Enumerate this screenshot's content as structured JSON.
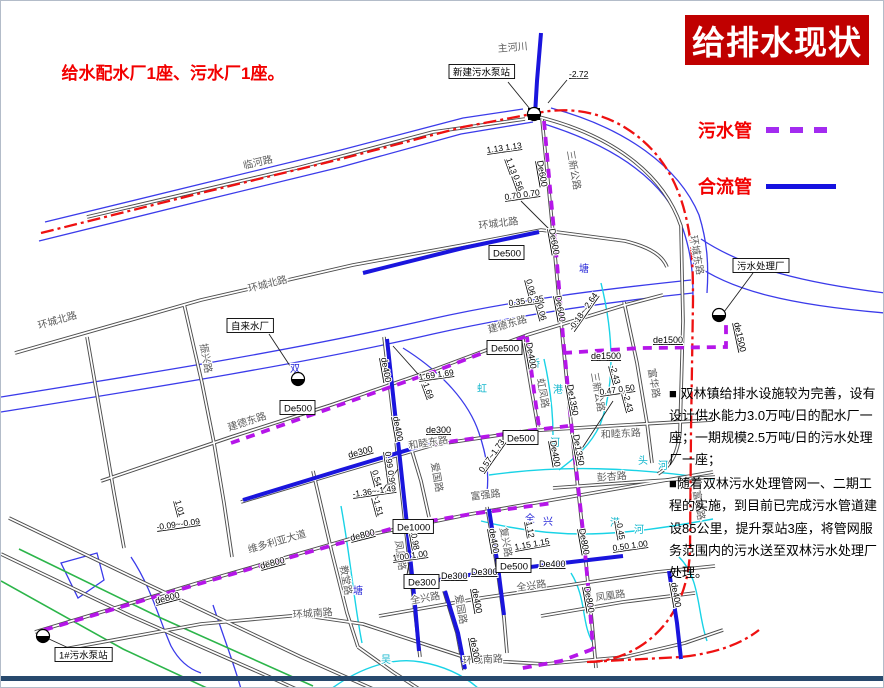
{
  "title": {
    "text": "给排水现状",
    "bg": "#c00000",
    "color": "#ffffff"
  },
  "legend": {
    "items": [
      {
        "label": "污水管",
        "style": "dashed",
        "color": "#a32bf0"
      },
      {
        "label": "合流管",
        "style": "solid",
        "color": "#1512e0"
      }
    ]
  },
  "note": {
    "text": "给水配水厂1座、污水厂1座。"
  },
  "description": {
    "p1": "■ 双林镇给排水设施较为完善，设有设计供水能力3.0万吨/日的配水厂一座；一期规模2.5万吨/日的污水处理厂一座；",
    "p2": "■随着双林污水处理管网一、二期工程的实施，到目前已完成污水管道建设85公里，提升泵站3座，将管网服务范围内的污水送至双林污水处理厂处理。"
  },
  "footer": {
    "bar_color": "#27496d"
  },
  "map": {
    "colors": {
      "road": "#4d4d4d",
      "river": "#3b3bea",
      "river_text": "#2929d8",
      "canal": "#19d3e6",
      "canal_text": "#10b6cc",
      "green": "#2cb54a",
      "boundary": "#ee1111",
      "sewage": "#b516e9",
      "combined": "#1a15dd"
    },
    "roads": [
      "M86,216 L300,166 L432,131 L524,118",
      "M538,116 C610,134 662,172 680,225 L682,320 L679,430 C677,455 668,466 657,473",
      "M14,352 L200,299 L352,264 L462,244 L540,229 L624,240 C652,247 662,256 666,266",
      "M100,480 L230,436 L330,404 L432,369 L526,334 L624,304 L662,294",
      "M240,501 L340,471 L432,444 L526,430 L624,424 L712,419",
      "M34,631 L200,581 L352,537 L470,513 L580,494 L712,471",
      "M378,615 L480,597 L562,585 L656,571 L714,565",
      "M58,649 L200,623 L300,614 L362,623 L432,646 L472,659 L544,663 L624,656 L684,642 L722,629",
      "M383,336 L395,440 L404,522 L413,602 L419,656",
      "M541,118 L552,232 L561,332 L573,452 L583,542 L591,622 L595,667",
      "M312,470 L331,552 L346,612 L357,646",
      "M486,506 L496,566 L503,617 L506,652",
      "M408,440 L420,480 L428,516",
      "M443,590 L456,632 L463,669",
      "M183,303 L201,382 L213,442 L223,502 L231,556",
      "M86,336 L101,422 L113,492 L123,547",
      "M623,301 L636,362 L646,422 L651,462",
      "M552,487 L650,480 L714,476",
      "M8,517 L150,585 L300,656 L372,688",
      "M0,553 L130,615 L262,673 L295,688",
      "M357,646 L392,671 L418,688",
      "M522,338 L531,392 L537,426",
      "M540,615 L622,601 L694,592"
    ],
    "rivers": [
      "M38,240 L200,200 L340,166 L460,133 L532,121",
      "M44,221 L200,183 L340,149 L462,117 L522,108",
      "M540,122 C615,145 664,180 682,228 C690,252 692,270 692,296",
      "M550,107 C625,127 678,166 698,214 C706,240 708,262 706,292",
      "M692,262 C730,290 790,304 884,312",
      "M700,238 C745,268 805,282 884,292",
      "M0,396 C150,372 300,348 430,318 C520,298 605,288 690,279",
      "M0,411 C150,387 302,363 432,333 C522,313 606,301 692,292",
      "M402,347 C442,372 468,402 478,432 C486,456 488,472 486,492",
      "M60,562 L96,552 L103,579 L77,597 Z",
      "M130,556 C150,586 158,618 170,645 C178,660 188,668 200,672",
      "M212,604 C224,640 234,666 240,688"
    ],
    "canals": [
      "M600,282 C613,335 614,385 599,424 C588,447 572,458 558,469",
      "M543,358 C549,385 552,410 552,434",
      "M488,474 C560,464 630,466 712,478",
      "M480,520 C560,540 620,535 712,518",
      "M340,505 C350,560 353,602 361,642",
      "M330,688 C360,666 392,656 420,661 C448,666 466,677 478,688",
      "M570,572 C586,598 580,622 592,642",
      "M678,556 C700,578 696,612 706,640"
    ],
    "greens": [
      "M18,548 L160,617 L312,685",
      "M0,580 L122,648 L208,688"
    ],
    "boundary": [
      "M40,232 L200,192 L340,158 L462,126 L536,112 C566,106 592,110 616,122 C652,141 674,172 684,212 C691,240 692,262 692,300 L690,430 L689,548 C688,592 670,626 638,646 C618,658 600,661 586,661",
      "M586,661 L680,656 C716,652 740,643 758,629"
    ],
    "combined_pipes": [
      "M362,272 L462,247 L538,231",
      "M540,32 L536,80 L534,114",
      "M386,338 L397,440 L406,524 L414,604 L418,650",
      "M242,499 L340,469 L430,442",
      "M408,584 L480,572 L562,562 L622,555",
      "M488,508 L497,566 L503,614",
      "M444,590 L457,632 L464,668",
      "M668,570 L676,622 L680,658"
    ],
    "sewage_pipes": [
      "M543,120 L550,198 L556,262 L562,335 L570,420 L576,475 L582,530 L588,595 L592,648",
      "M562,352 L640,347 L725,346 L725,318",
      "M230,442 L330,407 L432,371 L526,335",
      "M43,629 L150,597 L262,564 L400,525 L470,513 L552,502",
      "M432,443 L525,430 L567,425",
      "M526,336 L533,390 L538,426",
      "M592,648 L560,660 L516,668"
    ],
    "leaders": [
      [
        507,
        81,
        529,
        108
      ],
      [
        566,
        79,
        547,
        102
      ],
      [
        268,
        333,
        295,
        374
      ],
      [
        752,
        272,
        723,
        311
      ],
      [
        72,
        649,
        48,
        638
      ],
      [
        520,
        200,
        549,
        229
      ],
      [
        612,
        400,
        578,
        452
      ],
      [
        425,
        382,
        392,
        345
      ],
      [
        375,
        498,
        397,
        468
      ],
      [
        408,
        562,
        405,
        580
      ]
    ],
    "road_labels": [
      {
        "t": "临河路",
        "x": 243,
        "y": 168,
        "r": -13
      },
      {
        "t": "环城北路",
        "x": 38,
        "y": 328,
        "r": -16
      },
      {
        "t": "环城北路",
        "x": 248,
        "y": 291,
        "r": -14
      },
      {
        "t": "环城北路",
        "x": 478,
        "y": 228,
        "r": -7
      },
      {
        "t": "环城东路",
        "x": 689,
        "y": 235,
        "r": 80
      },
      {
        "t": "建德东路",
        "x": 228,
        "y": 430,
        "r": -18
      },
      {
        "t": "建德东路",
        "x": 488,
        "y": 332,
        "r": -16
      },
      {
        "t": "和睦东路",
        "x": 408,
        "y": 448,
        "r": -9
      },
      {
        "t": "和睦东路",
        "x": 600,
        "y": 437,
        "r": -3
      },
      {
        "t": "维多利亚大道",
        "x": 248,
        "y": 552,
        "r": -16
      },
      {
        "t": "富强路",
        "x": 470,
        "y": 499,
        "r": -7
      },
      {
        "t": "全兴路",
        "x": 410,
        "y": 603,
        "r": -10
      },
      {
        "t": "全兴路",
        "x": 516,
        "y": 590,
        "r": -8
      },
      {
        "t": "环城南路",
        "x": 292,
        "y": 617,
        "r": -4
      },
      {
        "t": "环城南路",
        "x": 462,
        "y": 663,
        "r": -3
      },
      {
        "t": "凤凰路",
        "x": 394,
        "y": 540,
        "r": 82
      },
      {
        "t": "凤凰路",
        "x": 595,
        "y": 600,
        "r": -8
      },
      {
        "t": "教堂路",
        "x": 339,
        "y": 565,
        "r": 80
      },
      {
        "t": "爱国路",
        "x": 430,
        "y": 462,
        "r": 80
      },
      {
        "t": "爱园路",
        "x": 454,
        "y": 594,
        "r": 80
      },
      {
        "t": "复兴路",
        "x": 499,
        "y": 527,
        "r": 80
      },
      {
        "t": "振兴路",
        "x": 199,
        "y": 343,
        "r": 80
      },
      {
        "t": "三新公路",
        "x": 566,
        "y": 150,
        "r": 80
      },
      {
        "t": "三新公路",
        "x": 590,
        "y": 372,
        "r": 80
      },
      {
        "t": "富华路",
        "x": 647,
        "y": 368,
        "r": 80
      },
      {
        "t": "彭杏路",
        "x": 596,
        "y": 480,
        "r": -4
      },
      {
        "t": "虹凤路",
        "x": 536,
        "y": 378,
        "r": 80
      },
      {
        "t": "富安路",
        "x": 692,
        "y": 490,
        "r": 80
      },
      {
        "t": "主河川",
        "x": 497,
        "y": 51,
        "r": -5,
        "s": 8
      }
    ],
    "river_labels": [
      {
        "t": "塘",
        "x": 578,
        "y": 271,
        "c": "b"
      },
      {
        "t": "双",
        "x": 289,
        "y": 371,
        "c": "b"
      },
      {
        "t": "塘",
        "x": 352,
        "y": 593,
        "c": "b"
      },
      {
        "t": "吴",
        "x": 380,
        "y": 662,
        "c": "c"
      },
      {
        "t": "虹",
        "x": 476,
        "y": 391,
        "c": "c"
      },
      {
        "t": "桥",
        "x": 529,
        "y": 366,
        "c": "c"
      },
      {
        "t": "港",
        "x": 552,
        "y": 392,
        "c": "c"
      },
      {
        "t": "头",
        "x": 637,
        "y": 463,
        "c": "c"
      },
      {
        "t": "河",
        "x": 657,
        "y": 468,
        "c": "c"
      },
      {
        "t": "港",
        "x": 609,
        "y": 525,
        "c": "c"
      },
      {
        "t": "河",
        "x": 633,
        "y": 532,
        "c": "c"
      },
      {
        "t": "全",
        "x": 524,
        "y": 521,
        "c": "b"
      },
      {
        "t": "兴",
        "x": 542,
        "y": 524,
        "c": "b"
      },
      {
        "t": "河",
        "x": 549,
        "y": 445,
        "c": "c"
      }
    ],
    "pipe_labels": [
      {
        "t": "De600",
        "x": 536,
        "y": 160,
        "r": 80
      },
      {
        "t": "De600",
        "x": 548,
        "y": 228,
        "r": 80
      },
      {
        "t": "De600",
        "x": 554,
        "y": 295,
        "r": 80
      },
      {
        "t": "De1350",
        "x": 566,
        "y": 384,
        "r": 80
      },
      {
        "t": "De1350",
        "x": 572,
        "y": 434,
        "r": 80
      },
      {
        "t": "De800",
        "x": 578,
        "y": 528,
        "r": 80
      },
      {
        "t": "De800",
        "x": 583,
        "y": 586,
        "r": 80
      },
      {
        "t": "de1500",
        "x": 590,
        "y": 358,
        "r": 0
      },
      {
        "t": "de1500",
        "x": 652,
        "y": 342,
        "r": 0
      },
      {
        "t": "de1500",
        "x": 733,
        "y": 322,
        "r": 78
      },
      {
        "t": "De500",
        "x": 283,
        "y": 410,
        "b": 1
      },
      {
        "t": "De500",
        "x": 490,
        "y": 350,
        "b": 1
      },
      {
        "t": "de800",
        "x": 155,
        "y": 603,
        "r": -15
      },
      {
        "t": "de800",
        "x": 260,
        "y": 568,
        "r": -15
      },
      {
        "t": "de800",
        "x": 350,
        "y": 540,
        "r": -14
      },
      {
        "t": "De1000",
        "x": 396,
        "y": 529,
        "b": 1
      },
      {
        "t": "De500",
        "x": 506,
        "y": 440,
        "b": 1
      },
      {
        "t": "De400",
        "x": 549,
        "y": 440,
        "r": 80
      },
      {
        "t": "De400",
        "x": 525,
        "y": 342,
        "r": 80
      },
      {
        "t": "De500",
        "x": 492,
        "y": 255,
        "b": 1
      },
      {
        "t": "De300",
        "x": 407,
        "y": 584,
        "b": 1
      },
      {
        "t": "de300",
        "x": 348,
        "y": 457,
        "r": -15
      },
      {
        "t": "de300",
        "x": 425,
        "y": 432,
        "r": 0
      },
      {
        "t": "De300",
        "x": 440,
        "y": 578,
        "r": 0
      },
      {
        "t": "De300",
        "x": 470,
        "y": 574,
        "r": 0
      },
      {
        "t": "De500",
        "x": 499,
        "y": 568,
        "b": 1
      },
      {
        "t": "De400",
        "x": 538,
        "y": 566,
        "r": 0
      },
      {
        "t": "de400",
        "x": 488,
        "y": 528,
        "r": 80
      },
      {
        "t": "de400",
        "x": 471,
        "y": 588,
        "r": 80
      },
      {
        "t": "de300",
        "x": 469,
        "y": 637,
        "r": 80
      },
      {
        "t": "de400",
        "x": 670,
        "y": 582,
        "r": 80
      },
      {
        "t": "de400",
        "x": 380,
        "y": 357,
        "r": 80
      },
      {
        "t": "de400",
        "x": 392,
        "y": 416,
        "r": 80
      }
    ],
    "values": [
      {
        "t": "-2.72",
        "x": 568,
        "y": 76,
        "r": 0
      },
      {
        "t": "1.13 1.13",
        "x": 486,
        "y": 152,
        "r": -8
      },
      {
        "t": "1.13",
        "x": 505,
        "y": 158,
        "r": 70
      },
      {
        "t": "0.56",
        "x": 512,
        "y": 175,
        "r": 70
      },
      {
        "t": "0.70 0.70",
        "x": 504,
        "y": 199,
        "r": -8
      },
      {
        "t": "0.06",
        "x": 525,
        "y": 279,
        "r": 75
      },
      {
        "t": "0.35 0.35",
        "x": 508,
        "y": 305,
        "r": -8
      },
      {
        "t": "0.06",
        "x": 536,
        "y": 304,
        "r": 75
      },
      {
        "t": "-0.18~-2.64",
        "x": 572,
        "y": 330,
        "r": -55
      },
      {
        "t": "1.69 1.69",
        "x": 418,
        "y": 379,
        "r": -8
      },
      {
        "t": "1.69",
        "x": 422,
        "y": 383,
        "r": 70
      },
      {
        "t": "-2.43",
        "x": 609,
        "y": 365,
        "r": 75
      },
      {
        "t": "0.47 0.50",
        "x": 599,
        "y": 394,
        "r": -8
      },
      {
        "t": "-2.43",
        "x": 622,
        "y": 393,
        "r": 75
      },
      {
        "t": "0.99 0.99",
        "x": 384,
        "y": 451,
        "r": 82
      },
      {
        "t": "0.54",
        "x": 371,
        "y": 470,
        "r": 75
      },
      {
        "t": "-1.36~-1.49",
        "x": 352,
        "y": 496,
        "r": -8
      },
      {
        "t": "-1.51",
        "x": 372,
        "y": 497,
        "r": 75
      },
      {
        "t": "1.01",
        "x": 174,
        "y": 500,
        "r": 75
      },
      {
        "t": "-0.09~-0.09",
        "x": 156,
        "y": 529,
        "r": -8
      },
      {
        "t": "0.98",
        "x": 410,
        "y": 533,
        "r": 80
      },
      {
        "t": "1.00 1.00",
        "x": 392,
        "y": 560,
        "r": -8
      },
      {
        "t": "1.12",
        "x": 525,
        "y": 521,
        "r": 80
      },
      {
        "t": "1.15 1.15",
        "x": 514,
        "y": 549,
        "r": -10
      },
      {
        "t": "-0.45",
        "x": 615,
        "y": 520,
        "r": 80
      },
      {
        "t": "0.50 1.00",
        "x": 612,
        "y": 550,
        "r": -8
      },
      {
        "t": "0.57~1.73",
        "x": 482,
        "y": 472,
        "r": -55
      }
    ],
    "facilities": [
      {
        "label": "新建污水泵站",
        "bx": 452,
        "by": 64,
        "sx": 533,
        "sy": 113,
        "sq": 1
      },
      {
        "label": "自来水厂",
        "bx": 230,
        "by": 318,
        "sx": 297,
        "sy": 378
      },
      {
        "label": "污水处理厂",
        "bx": 736,
        "by": 258,
        "sx": 718,
        "sy": 314
      },
      {
        "label": "1#污水泵站",
        "bx": 58,
        "by": 647,
        "sx": 42,
        "sy": 635
      }
    ]
  }
}
